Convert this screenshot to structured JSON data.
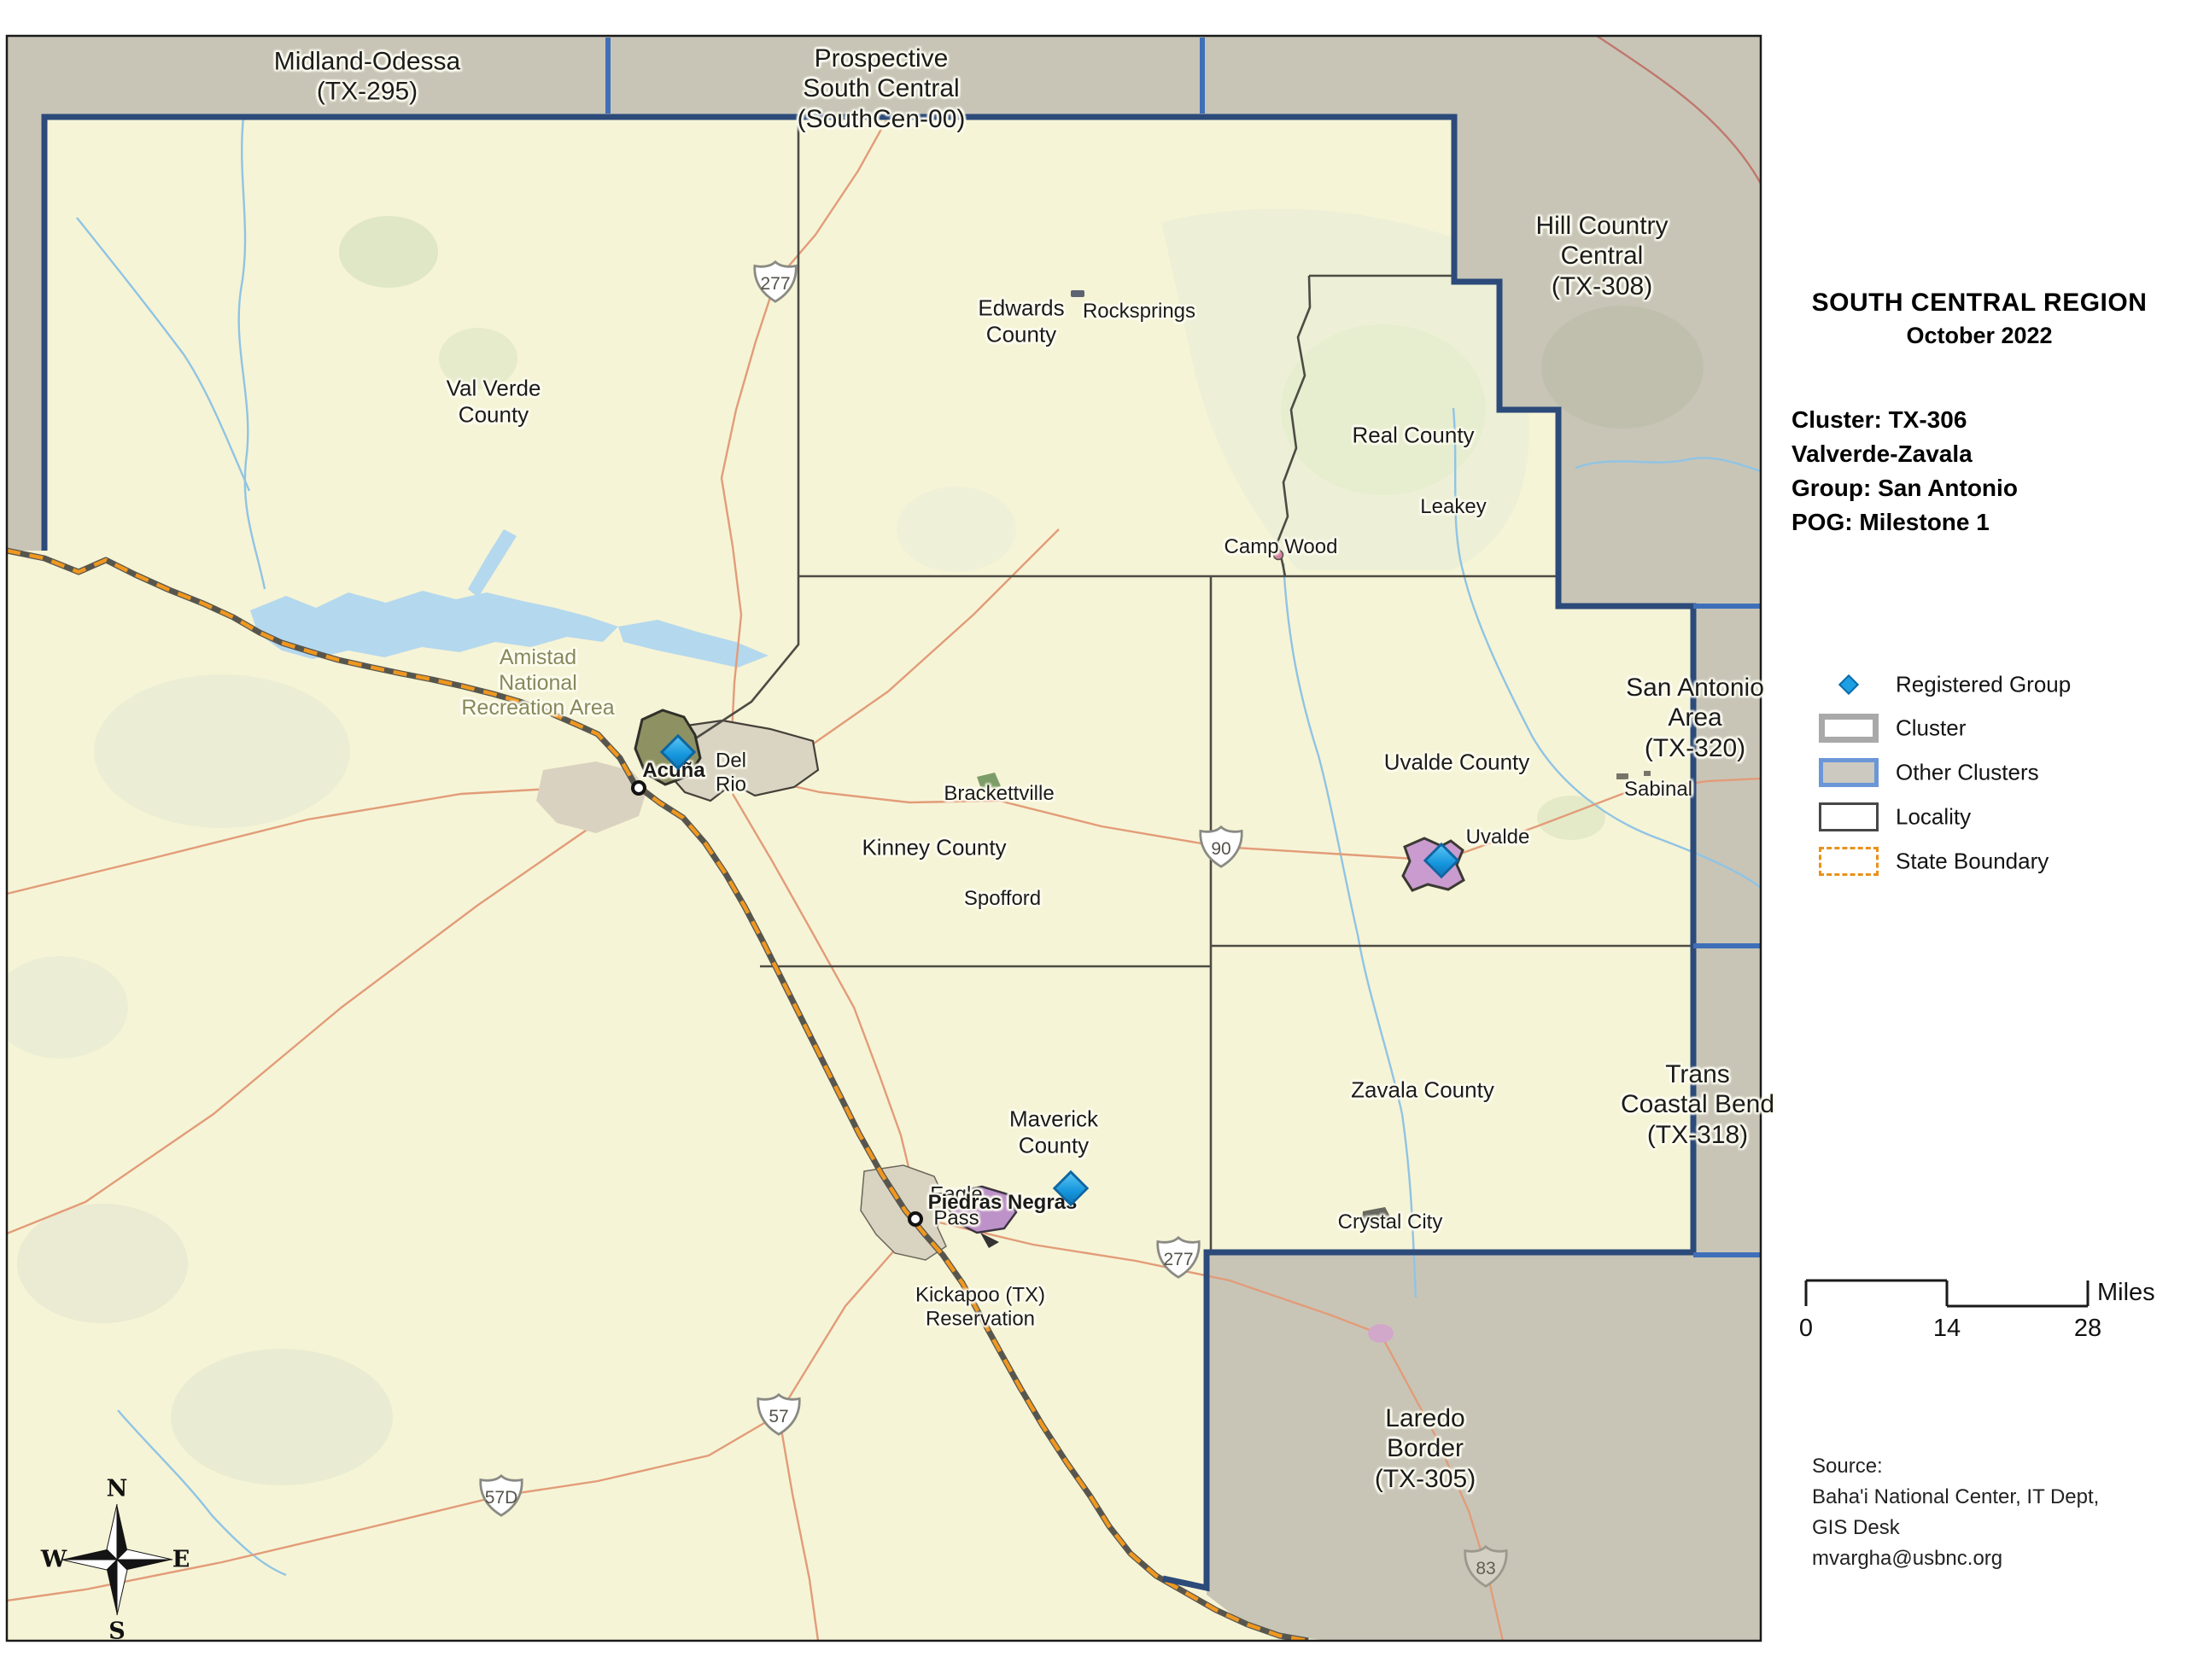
{
  "panel": {
    "title": "SOUTH CENTRAL REGION",
    "subtitle": "October 2022",
    "info_lines": [
      "Cluster: TX-306",
      "Valverde-Zavala",
      "Group: San Antonio",
      "POG: Milestone 1"
    ],
    "legend": {
      "registered_group": "Registered Group",
      "cluster": "Cluster",
      "other_clusters": "Other Clusters",
      "locality": "Locality",
      "state_boundary": "State Boundary"
    },
    "scale": {
      "zero": "0",
      "mid": "14",
      "max": "28",
      "unit": "Miles"
    },
    "source_lines": [
      "Source:",
      "Baha'i National Center, IT Dept,",
      "GIS Desk",
      "mvargha@usbnc.org"
    ]
  },
  "compass": {
    "n": "N",
    "e": "E",
    "s": "S",
    "w": "W"
  },
  "map": {
    "other_cluster_labels": [
      {
        "text": "Midland-Odessa\n(TX-295)"
      },
      {
        "text": "Prospective\nSouth Central\n(SouthCen-00)"
      },
      {
        "text": "Hill Country\nCentral\n(TX-308)"
      },
      {
        "text": "San Antonio\nArea\n(TX-320)"
      },
      {
        "text": "Trans\nCoastal Bend\n(TX-318)"
      },
      {
        "text": "Laredo\nBorder\n(TX-305)"
      }
    ],
    "county_labels": [
      {
        "text": "Val Verde\nCounty"
      },
      {
        "text": "Edwards\nCounty"
      },
      {
        "text": "Real County"
      },
      {
        "text": "Kinney County"
      },
      {
        "text": "Uvalde County"
      },
      {
        "text": "Maverick\nCounty"
      },
      {
        "text": "Zavala County"
      }
    ],
    "place_labels": [
      {
        "text": "Rocksprings"
      },
      {
        "text": "Leakey"
      },
      {
        "text": "Camp Wood"
      },
      {
        "text": "Brackettville"
      },
      {
        "text": "Spofford"
      },
      {
        "text": "Del\nRio"
      },
      {
        "text": "Acuña"
      },
      {
        "text": "Sabinal"
      },
      {
        "text": "Uvalde"
      },
      {
        "text": "Eagle\nPass"
      },
      {
        "text": "Piedras Negras"
      },
      {
        "text": "Kickapoo (TX)\nReservation"
      },
      {
        "text": "Crystal City"
      }
    ],
    "area_labels": [
      {
        "text": "Amistad\nNational\nRecreation Area"
      }
    ],
    "highway_shields": [
      {
        "number": "277"
      },
      {
        "number": "90"
      },
      {
        "number": "277"
      },
      {
        "number": "57"
      },
      {
        "number": "57D"
      },
      {
        "number": "83"
      }
    ]
  },
  "colors": {
    "cluster_fill": "#f6f4d6",
    "other_cluster_fill": "#c8c5b7",
    "cluster_boundary": "#2c4a7a",
    "other_cluster_boundary": "#3f6fb8",
    "state_boundary_orange": "#ef9720",
    "registered_group_blue": "#1ea2e8",
    "river_blue": "#90c4e4",
    "road_salmon": "#e29c79"
  }
}
